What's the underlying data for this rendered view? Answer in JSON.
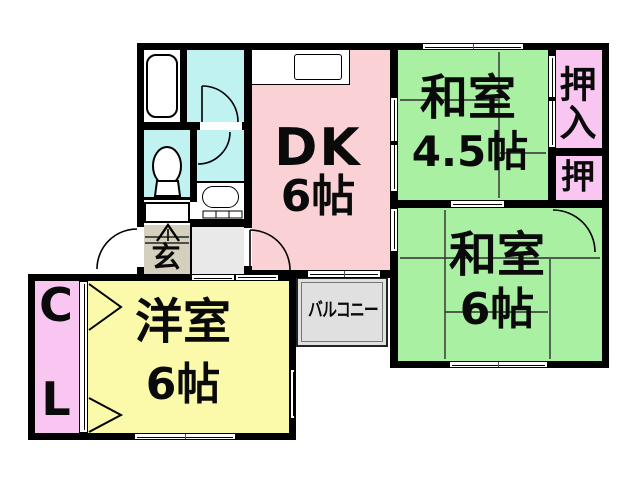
{
  "title": "apartment-floor-plan",
  "colors": {
    "tatami_green": "#a9f0a2",
    "dk_pink": "#fad2d6",
    "closet_pink": "#f9c6f2",
    "room_yellow": "#fafaaa",
    "bath_cyan": "#c0f2f2",
    "genkan_tan": "#d5cfbd",
    "balcony_gray": "#e0e0e0",
    "corridor_gray": "#e9e9e9",
    "wall_black": "#000000",
    "fixture_white": "#ffffff"
  },
  "rooms": {
    "dk": {
      "name": "DK",
      "size": "6帖"
    },
    "washitsu45": {
      "name": "和室",
      "size": "4.5帖"
    },
    "washitsu6": {
      "name": "和室",
      "size": "6帖"
    },
    "youshitsu": {
      "name": "洋室",
      "size": "6帖"
    }
  },
  "labels": {
    "oshiire": "押\n入",
    "oshi": "押",
    "closet_top": "C",
    "closet_bottom": "L",
    "genkan": "玄",
    "balcony": "バルコニー"
  }
}
